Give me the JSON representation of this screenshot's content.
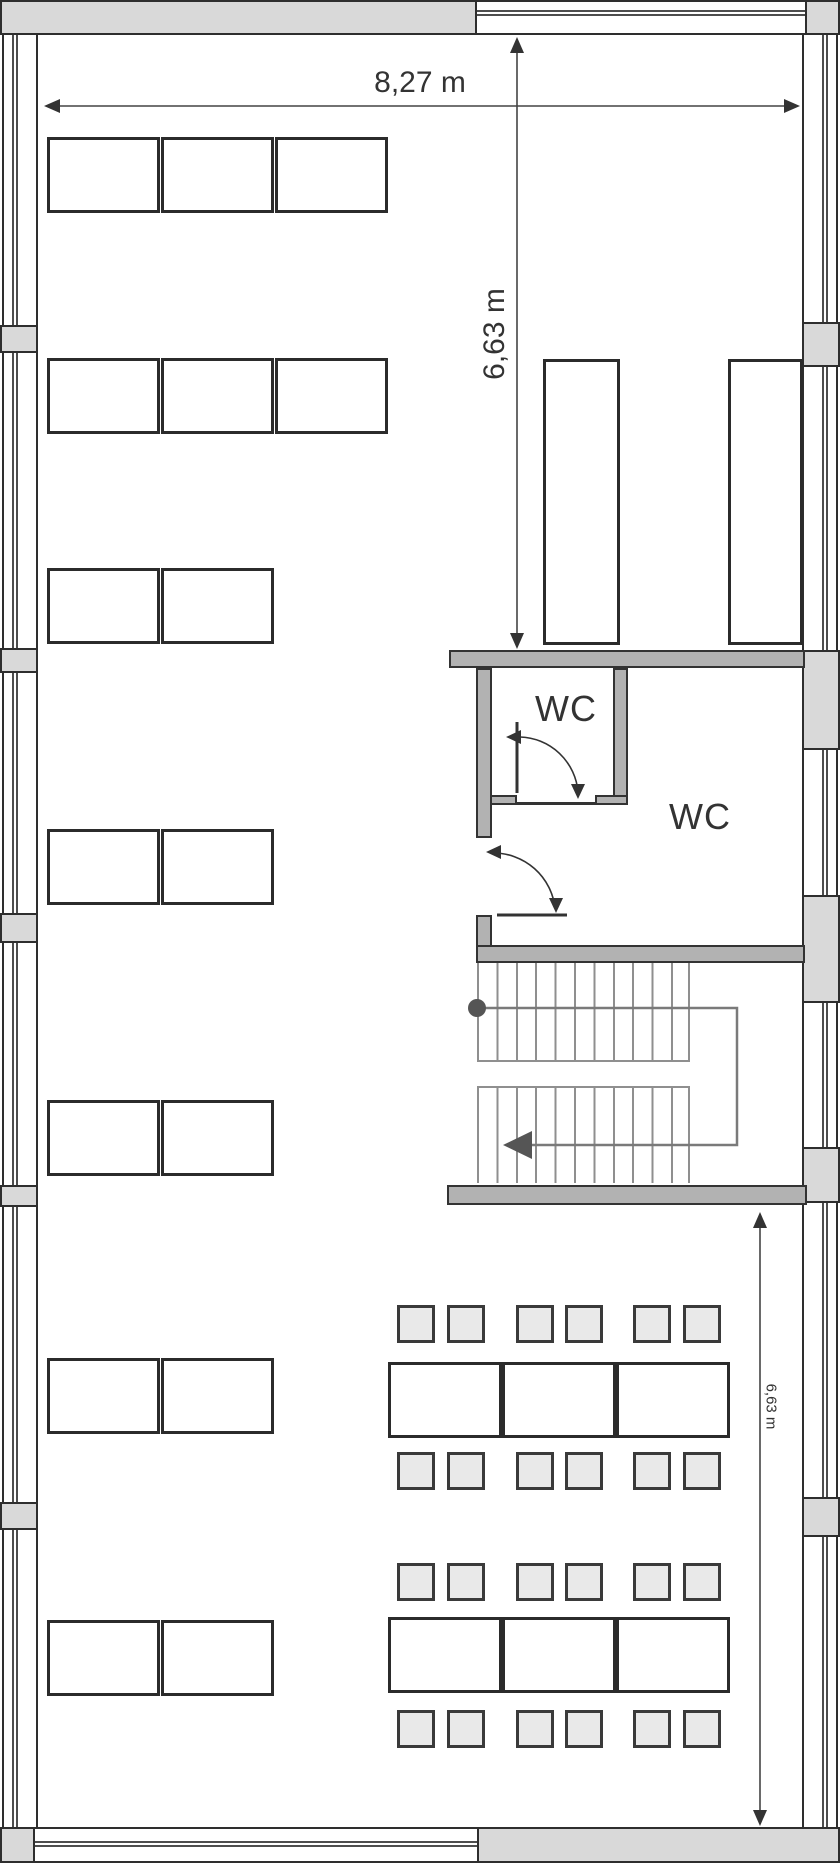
{
  "plan": {
    "title": "floor-plan",
    "dimensions": {
      "width": {
        "label": "8,27 m"
      },
      "height_upper": {
        "label": "6,63 m"
      },
      "height_lower": {
        "label": "6,63 m"
      }
    },
    "rooms": {
      "wc_small": {
        "label": "WC"
      },
      "wc_large": {
        "label": "WC"
      }
    },
    "colors": {
      "outline_dark": "#2e2e2e",
      "partition_wall_gray": "#b2b2b2",
      "facade_gray": "#d9d9d9",
      "chair_fill": "#e9e9e9",
      "table_fill": "#ffffff",
      "stair_tread_gray": "#8f8f8f",
      "walk_line_gray": "#7a7a7a",
      "text_gray": "#333333"
    }
  }
}
